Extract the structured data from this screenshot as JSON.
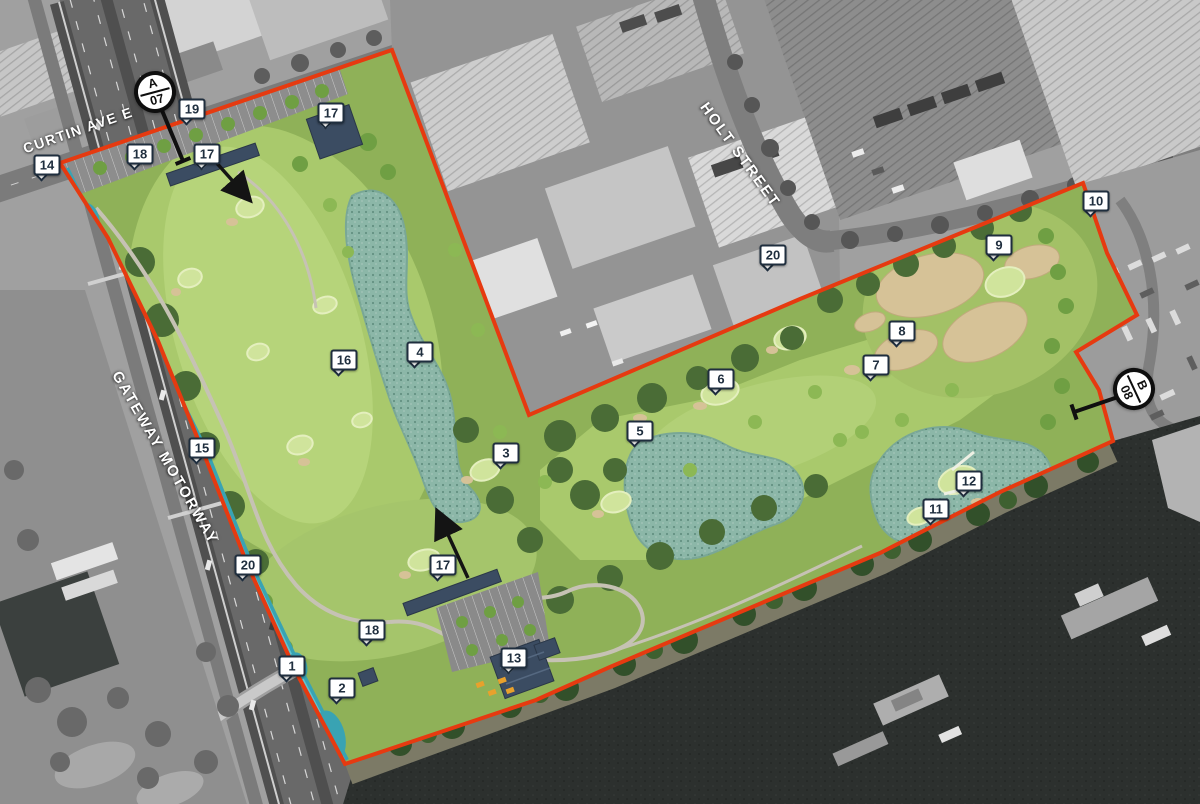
{
  "map": {
    "streets": [
      {
        "id": "curtin-ave-e",
        "label": "CURTIN AVE E"
      },
      {
        "id": "gateway-motorway",
        "label": "GATEWAY MOTORWAY"
      },
      {
        "id": "holt-street",
        "label": "HOLT STREET"
      }
    ],
    "pins": [
      {
        "label": "1",
        "x": 292,
        "y": 666
      },
      {
        "label": "2",
        "x": 342,
        "y": 688
      },
      {
        "label": "3",
        "x": 506,
        "y": 453
      },
      {
        "label": "4",
        "x": 420,
        "y": 352
      },
      {
        "label": "5",
        "x": 640,
        "y": 431
      },
      {
        "label": "6",
        "x": 721,
        "y": 379
      },
      {
        "label": "7",
        "x": 876,
        "y": 365
      },
      {
        "label": "8",
        "x": 902,
        "y": 331
      },
      {
        "label": "9",
        "x": 999,
        "y": 245
      },
      {
        "label": "10",
        "x": 1096,
        "y": 201
      },
      {
        "label": "11",
        "x": 936,
        "y": 509
      },
      {
        "label": "12",
        "x": 969,
        "y": 481
      },
      {
        "label": "13",
        "x": 514,
        "y": 658
      },
      {
        "label": "14",
        "x": 47,
        "y": 165
      },
      {
        "label": "15",
        "x": 202,
        "y": 448
      },
      {
        "label": "16",
        "x": 344,
        "y": 360
      },
      {
        "label": "17",
        "x": 207,
        "y": 154
      },
      {
        "label": "17",
        "x": 331,
        "y": 113
      },
      {
        "label": "17",
        "x": 443,
        "y": 565
      },
      {
        "label": "18",
        "x": 140,
        "y": 154
      },
      {
        "label": "18",
        "x": 372,
        "y": 630
      },
      {
        "label": "19",
        "x": 192,
        "y": 109
      },
      {
        "label": "20",
        "x": 773,
        "y": 255
      },
      {
        "label": "20",
        "x": 248,
        "y": 565
      }
    ],
    "sections": [
      {
        "letter": "A",
        "number": "07",
        "x": 155,
        "y": 92,
        "rotation": -15,
        "leader": {
          "x1": 161,
          "y1": 108,
          "x2": 183,
          "y2": 161
        }
      },
      {
        "letter": "B",
        "number": "08",
        "x": 1134,
        "y": 389,
        "rotation": 65,
        "leader": {
          "x1": 1118,
          "y1": 397,
          "x2": 1074,
          "y2": 412
        }
      }
    ],
    "colors": {
      "boundary": "#e63a10",
      "canal": "#39a3b3",
      "canal_core": "#63c4cf",
      "wetland": "#8cb7a8",
      "building": "#3b4c62",
      "pin_border": "#1f2e3e",
      "fairway": "#a9c96c",
      "green": "#d0e49c",
      "sand": "#d6c297",
      "river": "#2c302e"
    }
  }
}
